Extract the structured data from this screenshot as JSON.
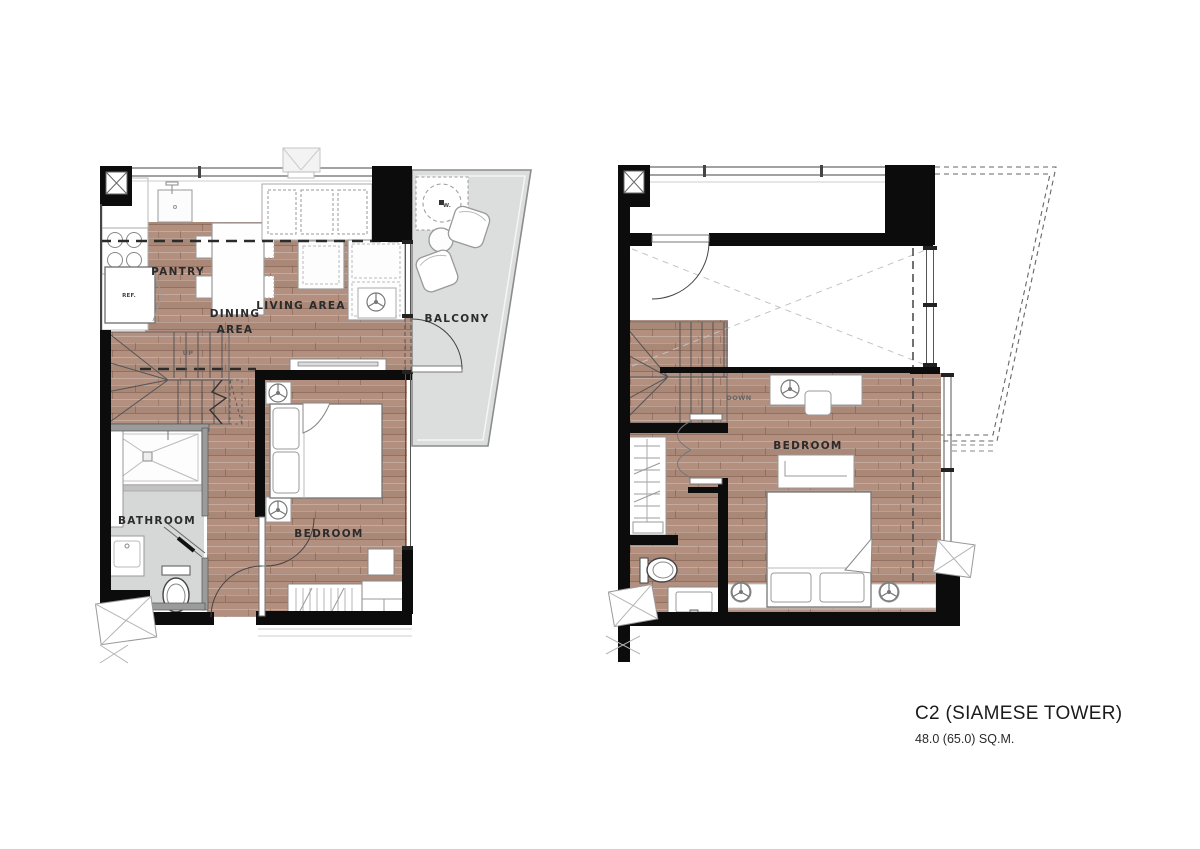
{
  "title_block": {
    "unit_name": "C2 (SIAMESE TOWER)",
    "area": "48.0 (65.0) SQ.M."
  },
  "plans": {
    "first_floor": {
      "labels": {
        "pantry": "PANTRY",
        "ref": "REF.",
        "dining_line1": "DINING",
        "dining_line2": "AREA",
        "living": "LIVING AREA",
        "balcony": "BALCONY",
        "washer": "W.",
        "up": "UP",
        "bathroom": "BATHROOM",
        "bedroom": "BEDROOM"
      }
    },
    "second_floor": {
      "labels": {
        "down": "DOWN",
        "bedroom": "BEDROOM"
      }
    }
  },
  "colors": {
    "wall": "#0c0c0c",
    "wood_floor": "#b28f7e",
    "balcony_floor": "#dcdddd",
    "bathroom_floor": "#d6d7d7",
    "line_grey": "#8c8c8c"
  }
}
